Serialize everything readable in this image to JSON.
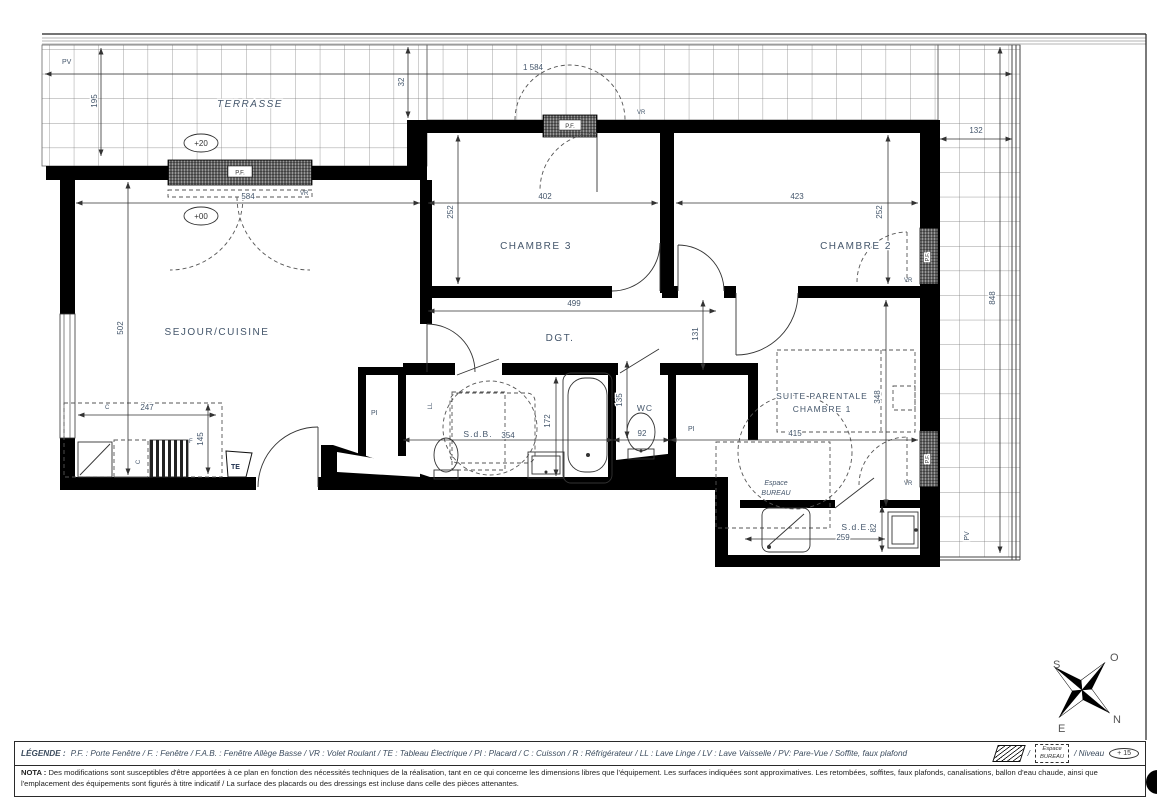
{
  "plan": {
    "rooms": {
      "terrasse": "TERRASSE",
      "sejour": "SEJOUR/CUISINE",
      "chambre3": "CHAMBRE 3",
      "chambre2": "CHAMBRE 2",
      "dgt": "DGT.",
      "sdb": "S.d.B.",
      "wc": "WC",
      "suite_l1": "SUITE PARENTALE",
      "suite_l2": "CHAMBRE 1",
      "espace_l1": "Espace",
      "espace_l2": "BUREAU",
      "sde": "S.d.E."
    },
    "levels": {
      "terrasse": "+20",
      "sejour": "+00"
    },
    "dims": {
      "terrasse_depth": "195",
      "terrasse_width": "1 584",
      "soffit": "32",
      "sejour_w": "584",
      "ch3_w": "402",
      "ch2_w": "423",
      "ch3_d": "252",
      "ch2_d": "252",
      "terrasse_side_w": "132",
      "terrasse_side_h": "848",
      "sejour_d": "502",
      "dgt_w": "499",
      "niche_d": "131",
      "kitchen_w": "247",
      "kitchen_d": "145",
      "sdb_w": "354",
      "sdb_d": "172",
      "wc_d": "135",
      "wc_w": "92",
      "suite_w": "415",
      "suite_d": "348",
      "sde_w": "259",
      "sde_d": "82"
    },
    "labels": {
      "pv_top": "PV",
      "pv_right": "PV",
      "pf": "P.F.",
      "vr": "VR",
      "te": "TE",
      "pi": "PI",
      "c": "C",
      "f": "F",
      "ll": "LL"
    },
    "compass": {
      "s": "S",
      "o": "O",
      "e": "E",
      "n": "N"
    }
  },
  "legend": {
    "label": "LÉGENDE :",
    "items": "P.F. : Porte Fenêtre / F. : Fenêtre / F.A.B. : Fenêtre Allège Basse / VR : Volet Roulant / TE : Tableau Électrique / PI : Placard / C : Cuisson / R : Réfrigérateur / LL : Lave Linge / LV : Lave Vaisselle / PV: Pare-Vue / Soffite, faux plafond",
    "sep1": "/",
    "espace_line1": "Espace",
    "espace_line2": "BUREAU",
    "niveau_label": "/ Niveau",
    "niveau_value": "+ 15"
  },
  "nota": {
    "label": "NOTA :",
    "text": "Des modifications sont susceptibles d'être apportées à ce plan en fonction des nécessités techniques de la réalisation, tant en ce qui concerne les dimensions libres que l'équipement. Les surfaces indiquées sont approximatives. Les retombées, soffites, faux plafonds, canalisations, ballon d'eau chaude, ainsi que l'emplacement des équipements sont figurés à titre indicatif / La surface des placards ou des dressings est incluse dans celle des pièces attenantes."
  },
  "colors": {
    "wall": "#000000",
    "plan_text": "#44566b",
    "grid": "#666666"
  }
}
